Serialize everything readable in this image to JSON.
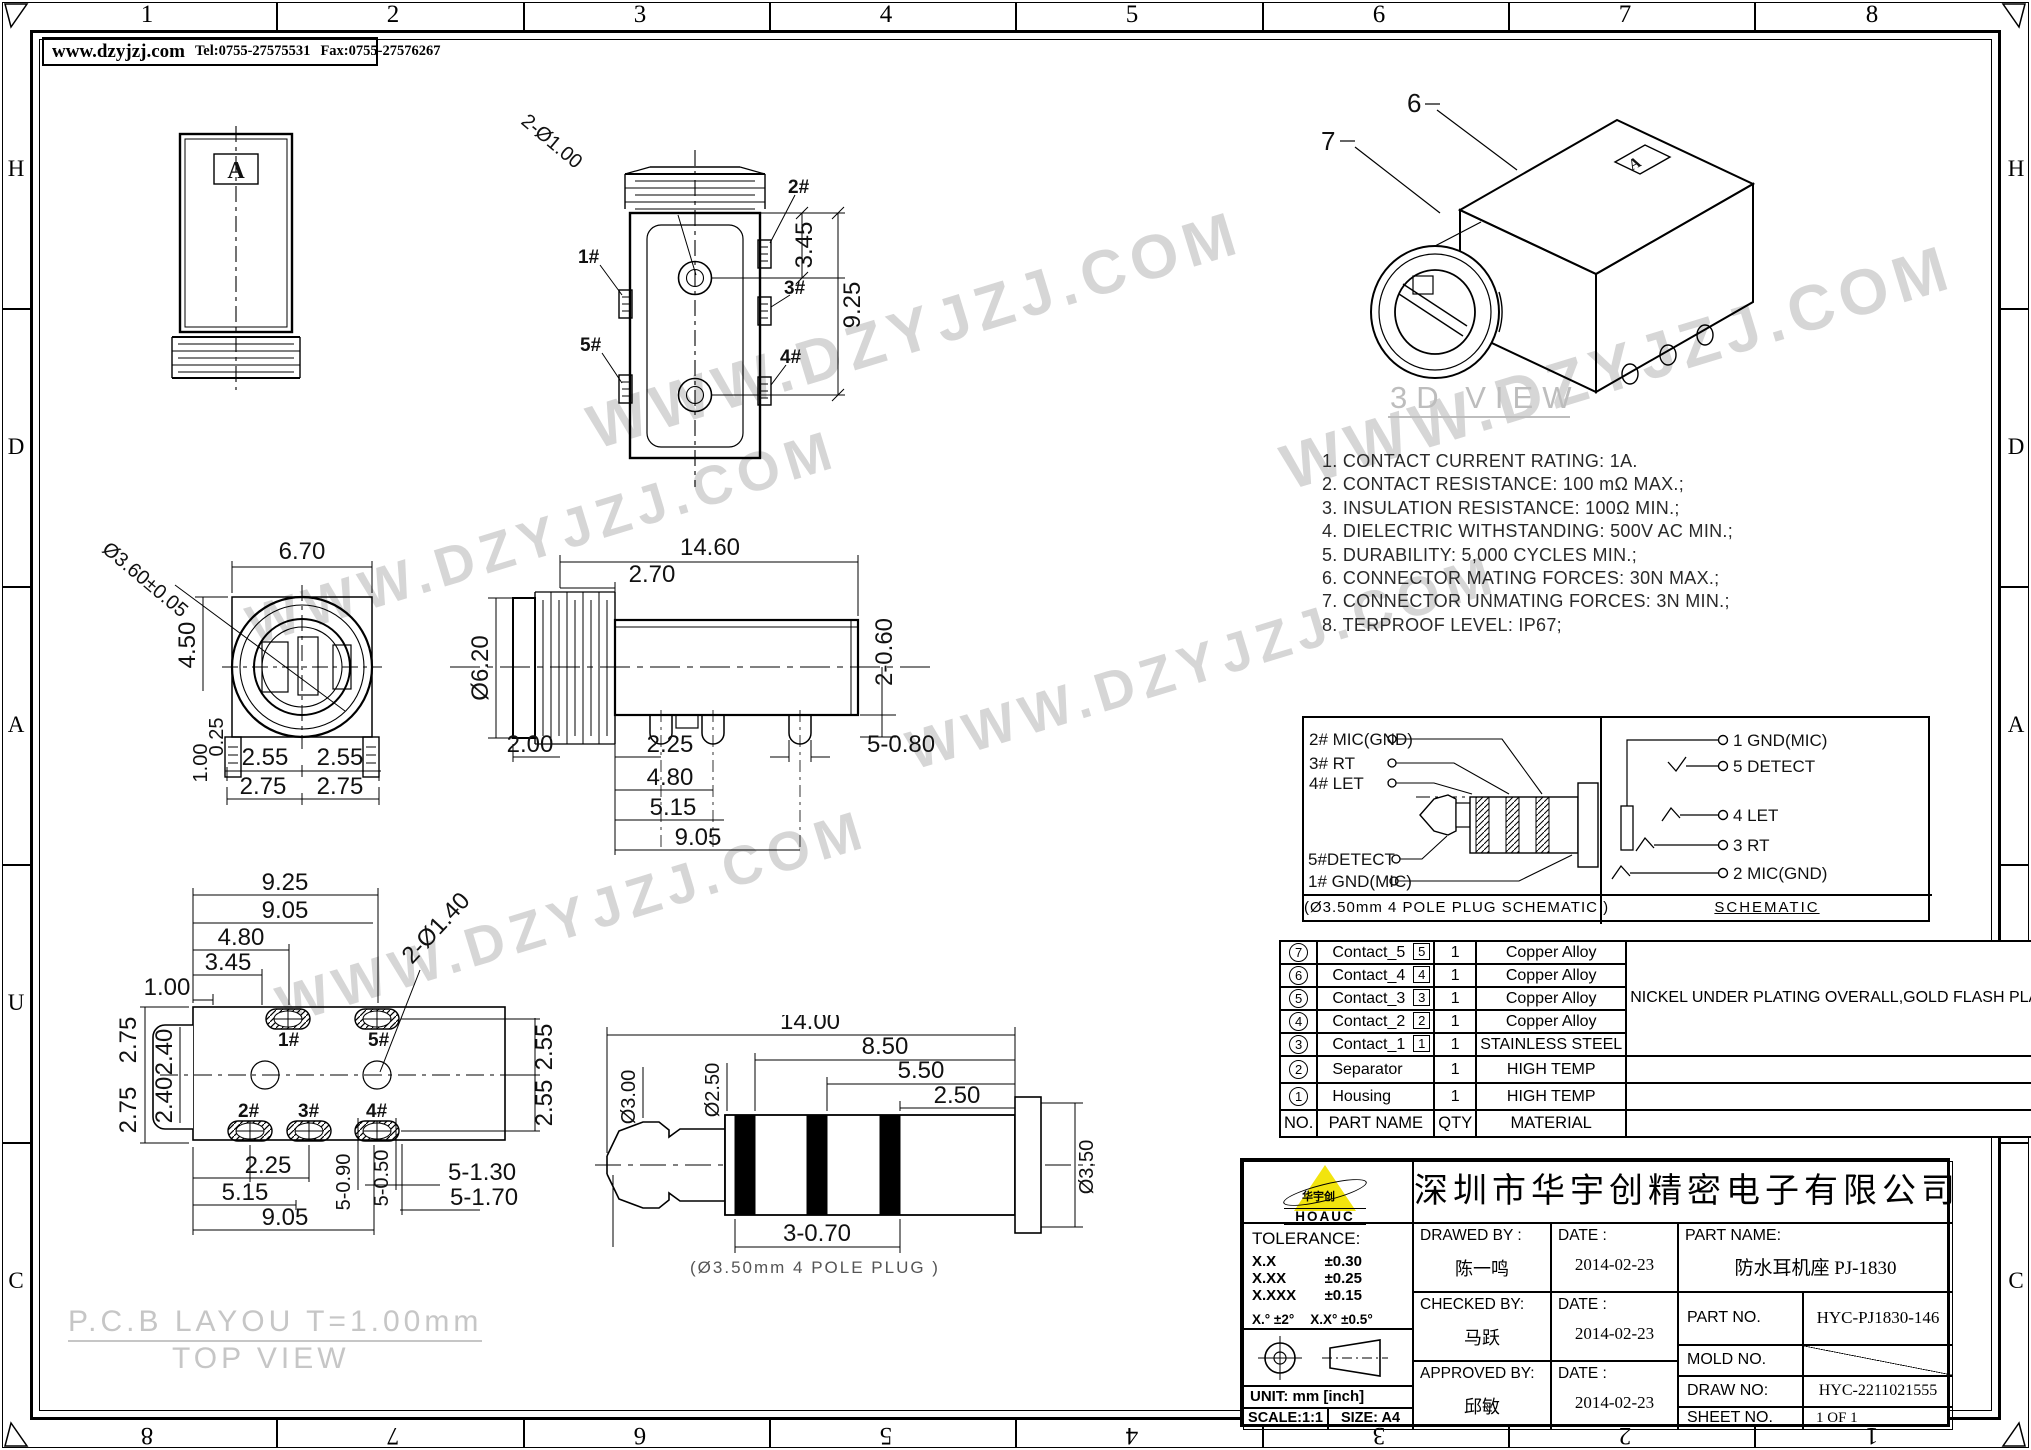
{
  "frame": {
    "top_zones": [
      "1",
      "2",
      "3",
      "4",
      "5",
      "6",
      "7",
      "8"
    ],
    "bottom_zones": [
      "8",
      "7",
      "6",
      "5",
      "4",
      "3",
      "2",
      "1"
    ],
    "side_zones": [
      "H",
      "D",
      "A",
      "U",
      "C"
    ]
  },
  "header": {
    "website": "www.dzyjzj.com",
    "tel": "Tel:0755-27575531",
    "fax": "Fax:0755-27576267"
  },
  "watermark": {
    "text": "WWW.DZYJZJ.COM"
  },
  "notes": [
    "1. CONTACT CURRENT RATING: 1A.",
    "2. CONTACT RESISTANCE: 100 mΩ MAX.;",
    "3. INSULATION RESISTANCE: 100Ω MIN.;",
    "4. DIELECTRIC WITHSTANDING: 500V AC MIN.;",
    "5. DURABILITY: 5,000 CYCLES MIN.;",
    "6. CONNECTOR MATING FORCES: 30N MAX.;",
    "7. CONNECTOR UNMATING FORCES: 3N MIN.;",
    "8. TERPROOF LEVEL: IP67;"
  ],
  "views": {
    "top": {
      "mark": "A"
    },
    "front": {
      "hole_label": "2-Ø1.00",
      "dim_345": "3.45",
      "dim_925": "9.25",
      "pin1": "1#",
      "pin2": "2#",
      "pin3": "3#",
      "pin4": "4#",
      "pin5": "5#"
    },
    "circle": {
      "dia": "Ø3.60±0.05",
      "width": "6.70",
      "height": "4.50",
      "off1": "1.00",
      "off2": "0.25",
      "b1": "2.55",
      "b2": "2.55",
      "b3": "2.75",
      "b4": "2.75"
    },
    "side": {
      "len": "14.60",
      "thread": "2.70",
      "dia": "Ø6.20",
      "tail": "2-0.60",
      "d1": "2.00",
      "d2": "2.25",
      "d3": "4.80",
      "d4": "5.15",
      "d5": "9.05",
      "d6": "5-0.80"
    },
    "three_d": {
      "label": "3D VIEW",
      "c6": "6",
      "c7": "7",
      "mark": "A"
    },
    "pcb": {
      "title": "P.C.B LAYOU T=1.00mm",
      "subtitle": "TOP VIEW",
      "w1": "9.25",
      "w2": "9.05",
      "w3": "4.80",
      "w4": "3.45",
      "w5": "1.00",
      "l1": "2.75",
      "l2": "2.40",
      "l3": "2.75",
      "l4": "2.40",
      "hole": "2-Ø1.40",
      "r1": "2.55",
      "r2": "2.55",
      "b1": "2.25",
      "b2": "5.15",
      "b3": "9.05",
      "v1": "5-0.90",
      "v2": "5-0.50",
      "s1": "5-1.30",
      "s2": "5-1.70",
      "p1": "1#",
      "p2": "2#",
      "p3": "3#",
      "p4": "4#",
      "p5": "5#"
    },
    "plug": {
      "len": "14.00",
      "d2": "8.50",
      "d3": "5.50",
      "d4": "2.50",
      "dia1": "Ø3.00",
      "dia2": "Ø2.50",
      "dia3": "Ø3.50",
      "band": "3-0.70",
      "caption": "(Ø3.50mm 4 POLE PLUG )"
    }
  },
  "schematic": {
    "l1": "2# MIC(GND)",
    "l2": "3# RT",
    "l3": "4# LET",
    "l4": "5#DETECT",
    "l5": "1# GND(MIC)",
    "left_caption": "(Ø3.50mm 4 POLE PLUG SCHEMATIC )",
    "r1": "1 GND(MIC)",
    "r2": "5 DETECT",
    "r3": "4 LET",
    "r4": "3 RT",
    "r5": "2 MIC(GND)",
    "right_caption": "SCHEMATIC"
  },
  "parts_table": {
    "headers": {
      "no": "NO.",
      "name": "PART NAME",
      "qty": "QTY",
      "material": "MATERIAL",
      "description": "DESCRIPTION",
      "remark": "REMARK"
    },
    "merged_description": "NICKEL UNDER PLATING OVERALL,GOLD FLASH PLATING ON SOLDER AREA ;GOLD FLASH PLATING ON CONTACT AREA",
    "rows": [
      {
        "no": "7",
        "name": "Contact_5",
        "tag": "5",
        "qty": "1",
        "material": "Copper Alloy",
        "remark": "T=0.20mm"
      },
      {
        "no": "6",
        "name": "Contact_4",
        "tag": "4",
        "qty": "1",
        "material": "Copper Alloy",
        "remark": "T=0.20mm"
      },
      {
        "no": "5",
        "name": "Contact_3",
        "tag": "3",
        "qty": "1",
        "material": "Copper Alloy",
        "remark": "T=0.20mm"
      },
      {
        "no": "4",
        "name": "Contact_2",
        "tag": "2",
        "qty": "1",
        "material": "Copper Alloy",
        "remark": "T=0.20mm"
      },
      {
        "no": "3",
        "name": "Contact_1",
        "tag": "1",
        "qty": "1",
        "material": "STAINLESS STEEL",
        "remark": "T=0.20mm"
      },
      {
        "no": "2",
        "name": "Separator",
        "qty": "1",
        "material": "HIGH TEMP",
        "description": "BLACK,UL94V-0"
      },
      {
        "no": "1",
        "name": "Housing",
        "qty": "1",
        "material": "HIGH TEMP",
        "description": "BLACK,UL94V-0"
      }
    ]
  },
  "title_block": {
    "company": "深圳市华宇创精密电子有限公司",
    "logo_text": "华宇创",
    "logo_sub": "HOAUC",
    "tolerance_title": "TOLERANCE:",
    "tol1": "X.X",
    "tol1v": "±0.30",
    "tol2": "X.XX",
    "tol2v": "±0.25",
    "tol3": "X.XXX",
    "tol3v": "±0.15",
    "tol_angle": "X.°  ±2°",
    "tol_angle2": "X.X°  ±0.5°",
    "unit": "UNIT:  mm  [inch]",
    "scale": "SCALE:1:1",
    "size": "SIZE:  A4",
    "drawed_label": "DRAWED  BY :",
    "drawed_by": "陈一鸣",
    "checked_label": "CHECKED  BY:",
    "checked_by": "马跃",
    "approved_label": "APPROVED  BY:",
    "approved_by": "邱敏",
    "date_label": "DATE :",
    "date1": "2014-02-23",
    "date2": "2014-02-23",
    "date3": "2014-02-23",
    "part_name_label": "PART  NAME:",
    "part_name": "防水耳机座 PJ-1830",
    "part_no_label": "PART  NO.",
    "part_no": "HYC-PJ1830-146",
    "mold_no_label": "MOLD  NO.",
    "draw_no_label": "DRAW  NO:",
    "draw_no": "HYC-2211021555",
    "sheet_no_label": "SHEET  NO.",
    "sheet_no": "1 OF 1"
  }
}
